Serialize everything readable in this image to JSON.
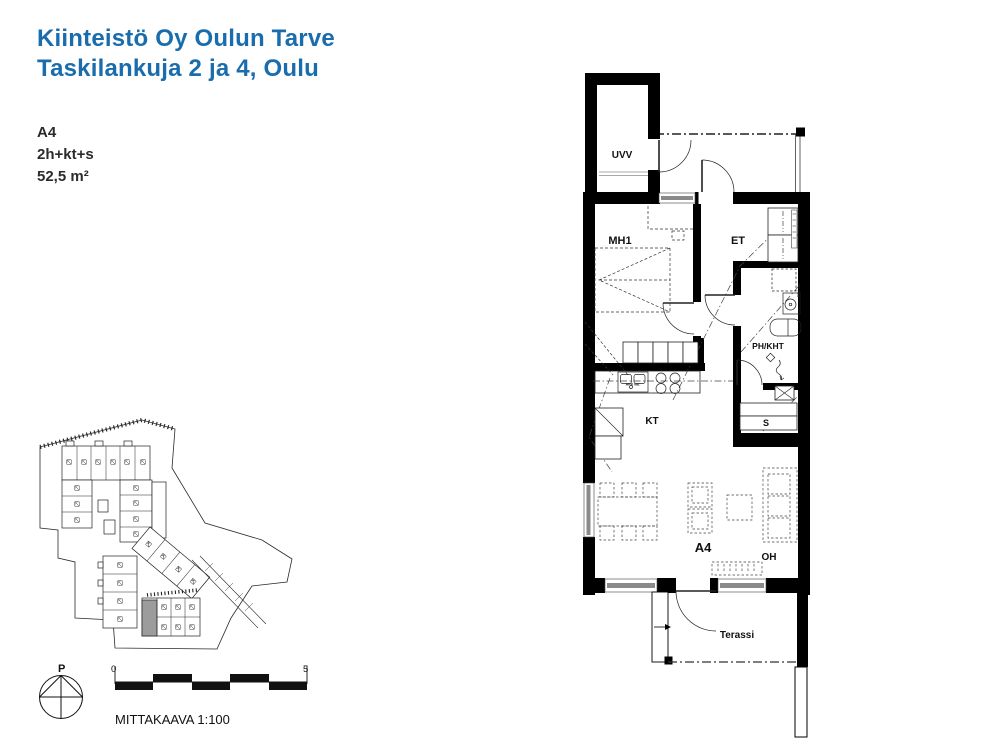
{
  "header": {
    "title_line1": "Kiinteistö Oy Oulun Tarve",
    "title_line2": "Taskilankuja 2 ja 4, Oulu",
    "accent_color": "#1a6dad"
  },
  "apartment": {
    "unit": "A4",
    "room_config": "2h+kt+s",
    "area": "52,5 m²"
  },
  "floor_plan": {
    "room_labels": {
      "storage": "UVV",
      "bedroom": "MH1",
      "entry": "ET",
      "bathroom": "PH/KHT",
      "sauna": "S",
      "kitchen": "KT",
      "living": "OH",
      "terrace": "Terassi"
    },
    "unit_label": "A4",
    "appliance_notes": {
      "dishwasher": "APK var.",
      "washer": "PPK var."
    }
  },
  "scale_bar": {
    "start_label": "0",
    "end_label": "5",
    "caption": "MITTAKAAVA 1:100"
  },
  "compass": {
    "north_label": "P"
  }
}
